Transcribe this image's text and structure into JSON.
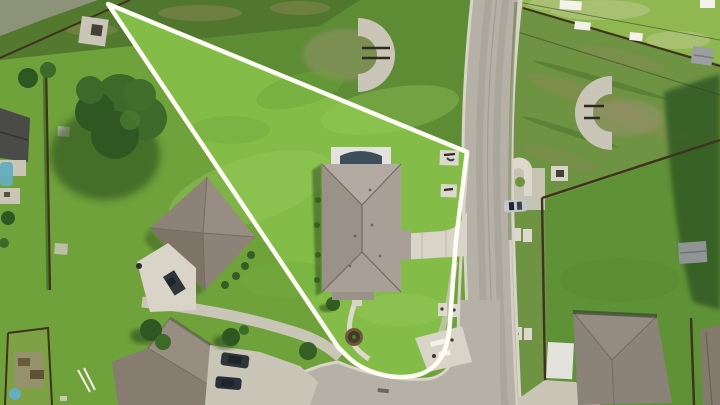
{
  "scene": {
    "type": "aerial-photo",
    "description": "Drone aerial view of a pie-shaped residential lot outlined with a white property boundary line; single gray hip-roof house on the lot, concrete street curving along the east side with a rounded corner at the bottom, neighboring houses, driveways, fences, sheds and trees around",
    "boundary_shape": "triangle with rounded street corner"
  },
  "palette": {
    "grass_base": "#6fa23b",
    "grass_bright": "#83bd47",
    "grass_bright2": "#99cb5d",
    "grass_north": "#5e8c34",
    "grass_dark_band": "#4f752d",
    "grass_field_bright": "#8fb850",
    "grass_field_pale": "#bcc88c",
    "grass_mid_right": "#6e9342",
    "grass_right_lot": "#5f9136",
    "tree_dark": "#2f5722",
    "tree_mid": "#3c6a28",
    "shadow_green": "#1e3a12",
    "road": "#b5b1a7",
    "road_wear": "#a39f94",
    "curb": "#d8d4c8",
    "concrete": "#d8d4c7",
    "concrete_dim": "#c9c5b7",
    "pad": "#dcd8cb",
    "dirt": "#8b8a55",
    "gravel": "#98936f",
    "boundary_line": "#fdfdf4",
    "roof_subject": "#a89f96",
    "roof_subject_light": "#b3aaa1",
    "roof_subject_dark": "#9a9188",
    "roof_west": "#8d8277",
    "roof_west_light": "#988d82",
    "roof_west_dark": "#7d7367",
    "roof_south": "#978d81",
    "roof_south_dark": "#867c70",
    "roof_se": "#8b8278",
    "roof_far": "#837a6e",
    "roof_dark_left": "#4a4a46",
    "ridge": "#746c65",
    "fence": "#3f321e",
    "patio_cover": "#e3e2dd",
    "awning_dark": "#3d4f5b",
    "pool_blue": "#64aec0",
    "car_silver": "#c3c7cb",
    "car_dark": "#30353a",
    "car_navy": "#28303c",
    "glass_dark": "#1d242b",
    "white_object": "#f2f1ea",
    "path_gray": "#8d9379",
    "utility_dark": "#454133"
  },
  "objects": {
    "boundary": "white property-line outline around vacant-style pie lot",
    "subject_house": "gray hip-roof house with white rear patio cover and dark awning",
    "driveway": "concrete driveway flaring from house to street",
    "walkway": "curved walkway from house to street corner",
    "street": "concrete street running top-to-bottom on right with side street at bottom",
    "parked_cars": [
      "silver car at street edge",
      "two dark cars on south neighbor driveway",
      "dark car on west neighbor driveway"
    ],
    "neighbors": [
      "west house",
      "south house",
      "southeast house across street",
      "far-right house edge",
      "far-left house with pool"
    ],
    "yard_items": [
      "horseshoe-shaped concrete pads",
      "bench pads",
      "tree ring",
      "white picnic objects",
      "sheds",
      "fences",
      "power lines",
      "large tree"
    ]
  }
}
